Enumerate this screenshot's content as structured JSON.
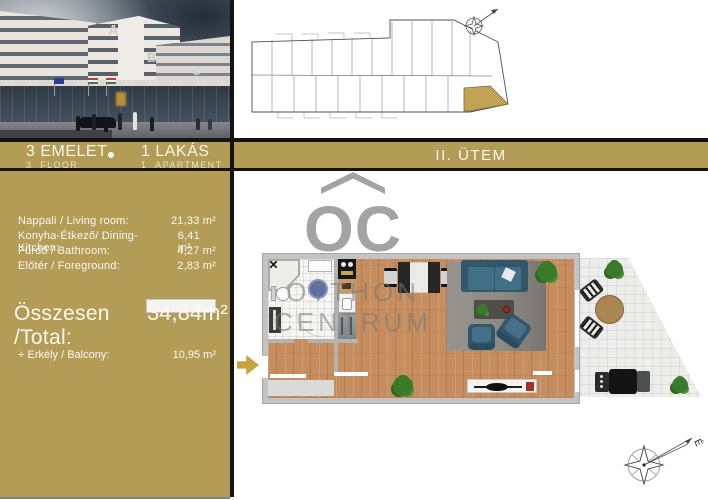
{
  "info_bar": {
    "floor_hu": "3 EMELET",
    "floor_en": "3  FLOOR",
    "apartment_hu": "1 LAKÁS",
    "apartment_en": "1  APARTMENT",
    "phase": "II. ÜTEM"
  },
  "areas": {
    "rooms": [
      {
        "name": "Nappali / Living room:",
        "value": "21,33 m²"
      },
      {
        "name": "Konyha-Étkező/ Dining-Kitchen:",
        "value": "6,41 m²"
      },
      {
        "name": "Fürdő / Bathroom:",
        "value": "4,27 m²"
      },
      {
        "name": "Előtér / Foreground:",
        "value": "2,83 m²"
      }
    ],
    "total_label": "Összesen /Total:",
    "total_value": "34,84m²",
    "balcony_label": "+ Erkély / Balcony:",
    "balcony_value": "10,95 m²"
  },
  "watermark": {
    "logo": "OC",
    "line1": "OTTHON",
    "line2": "CENTRUM"
  },
  "compass": {
    "north": "É"
  },
  "photo": {
    "letters": [
      "A",
      "B",
      "C"
    ]
  },
  "colors": {
    "gold": "#b39c56",
    "divider": "#15130f",
    "watermark_gray": "#a3a3a3",
    "wood": "#c68e5f",
    "sofa_teal": "#33566b",
    "highlight_gold": "#c2a255"
  }
}
